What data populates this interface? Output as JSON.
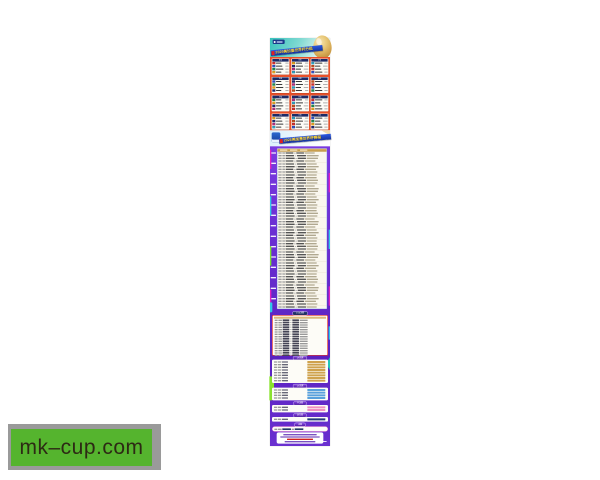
{
  "watermark": {
    "text": "mk–cup.com",
    "bg": "#55b42e",
    "backing": "#9a9a9a",
    "text_color": "#2d2a14"
  },
  "poster": {
    "group_section": {
      "title": "2026美加墨世界杯分组",
      "group_labels": [
        "A组",
        "B组",
        "C组",
        "D组",
        "E组",
        "F组",
        "G组",
        "H组",
        "I组",
        "J组",
        "K组",
        "L组"
      ],
      "teams_per_group": 4
    },
    "schedule_section": {
      "title": "2026美加墨世界杯赛程",
      "row_count": 59,
      "date_group_count": 15
    },
    "knockout_sections": [
      {
        "id": "round32",
        "label": "1/16决赛",
        "rows": 16,
        "accent": "#e03028"
      },
      {
        "id": "round16",
        "label": "1/8决赛",
        "rows": 8,
        "accent": "#cfa24e"
      },
      {
        "id": "quarter",
        "label": "1/4决赛",
        "rows": 4,
        "accent": "#58a0dc"
      },
      {
        "id": "semi",
        "label": "半决赛",
        "rows": 2,
        "accent": "#f090c0"
      },
      {
        "id": "third",
        "label": "季军赛",
        "rows": 1,
        "accent": "#223a7a"
      },
      {
        "id": "final",
        "label": "决赛",
        "rows": 1,
        "accent": "#e040c0"
      }
    ],
    "colors": {
      "header_teal": "#38c2bc",
      "section_orange": "#e8512a",
      "section_purple": "#6a2fd2",
      "ribbon_blue": "#1e4fd8",
      "title_yellow": "#ffd83a",
      "trophy_gold": "#d2a34e",
      "card_header_navy": "#1c2a66"
    }
  }
}
